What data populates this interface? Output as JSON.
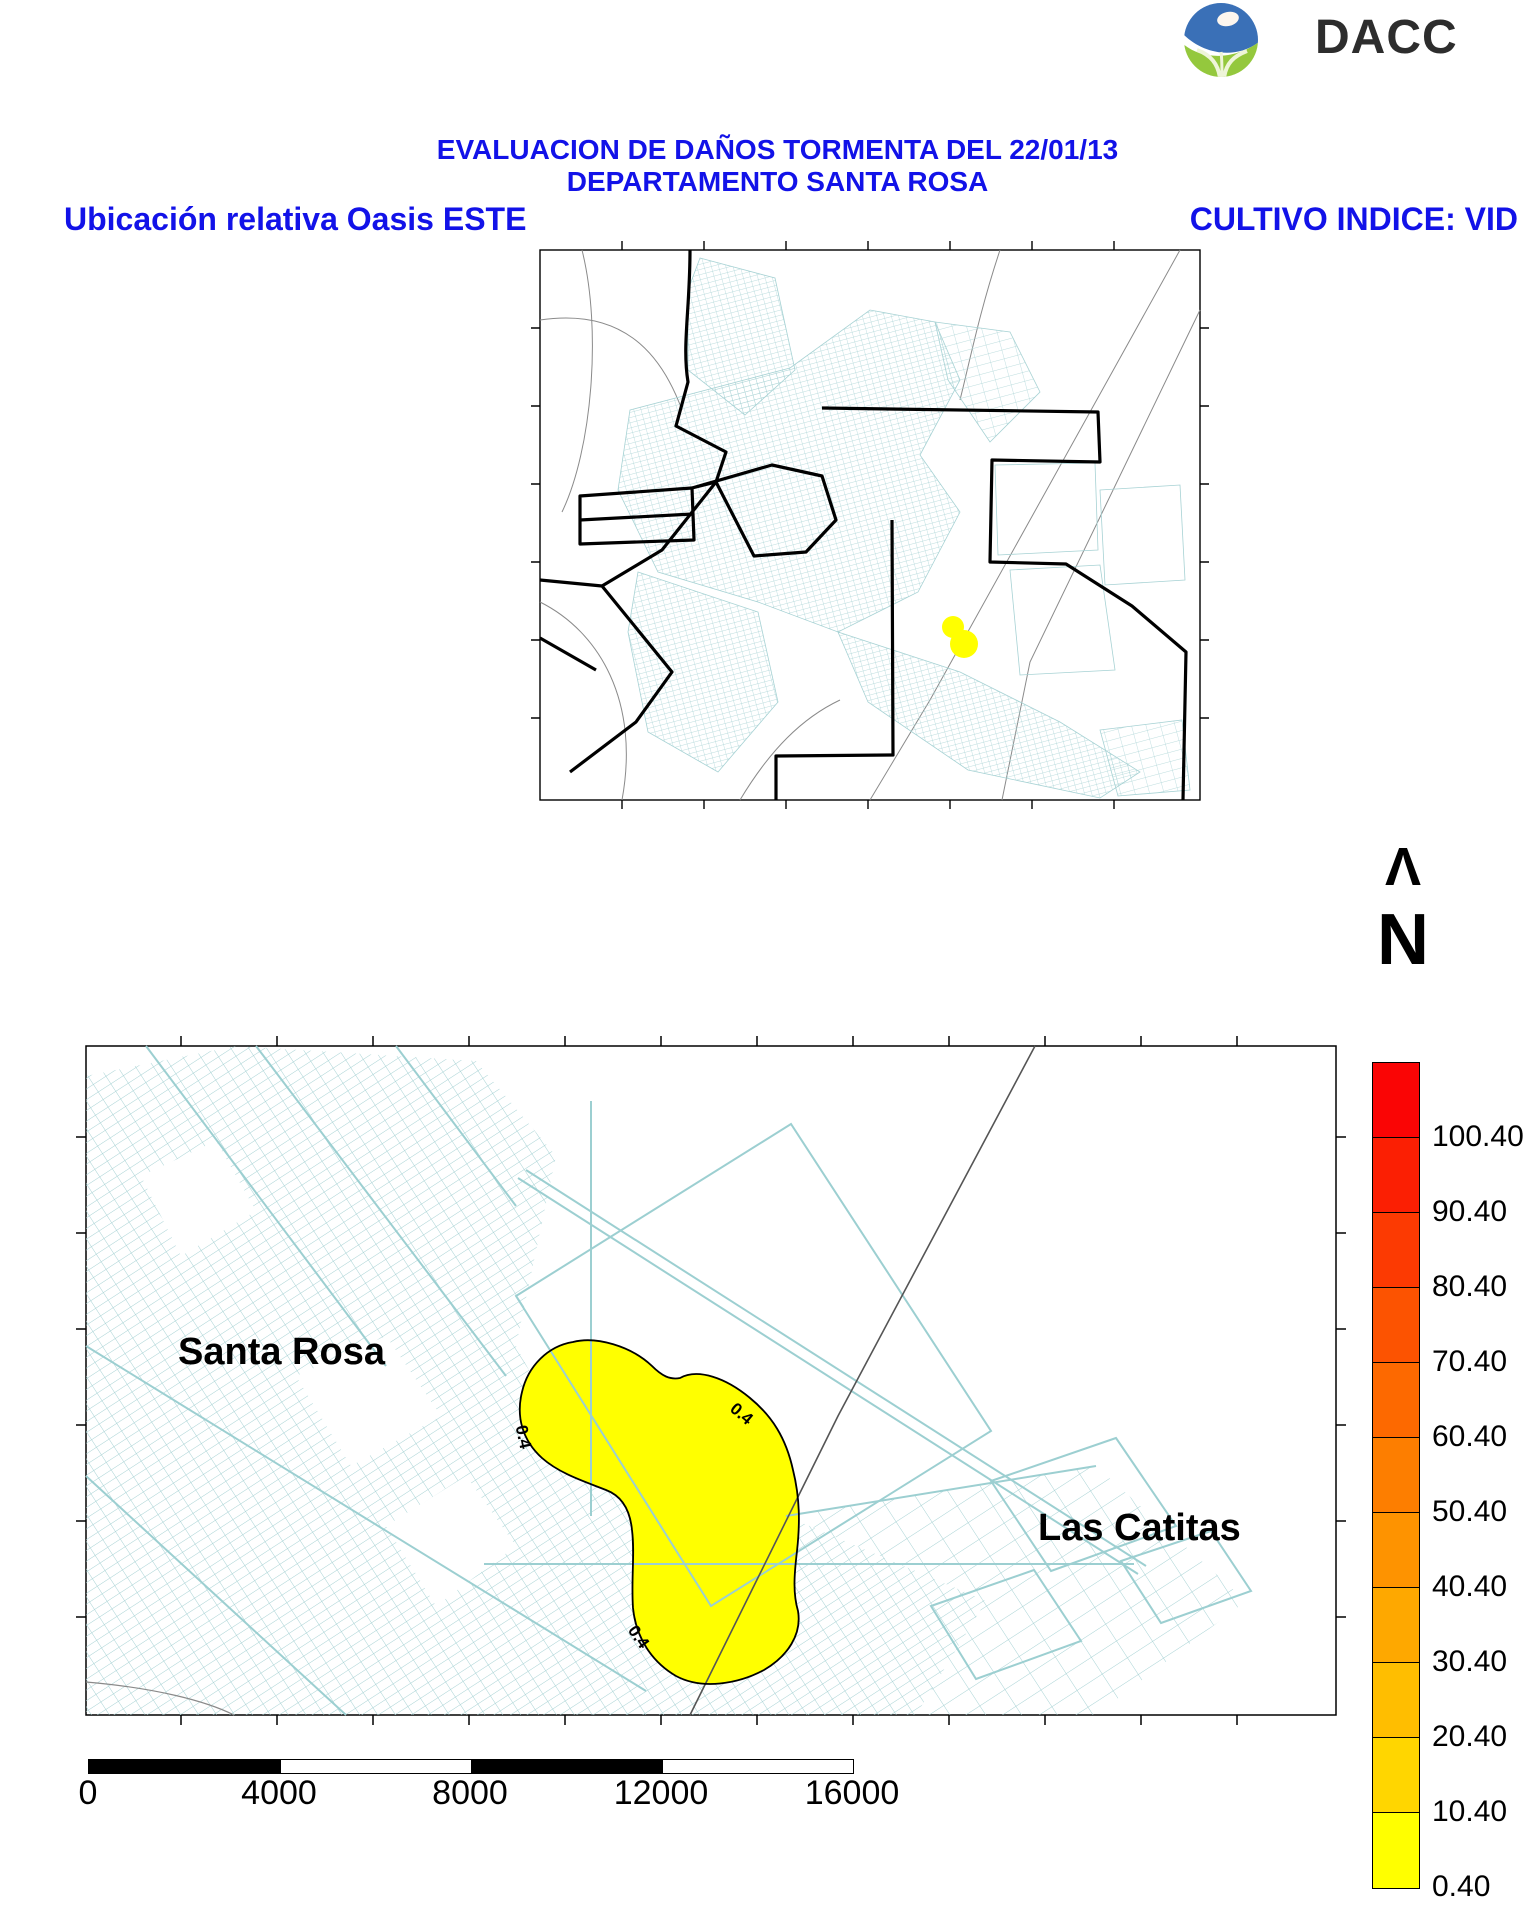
{
  "logo": {
    "text": "DACC"
  },
  "header": {
    "title_line1": "EVALUACION DE DAÑOS TORMENTA DEL 22/01/13",
    "title_line2": "DEPARTAMENTO SANTA ROSA",
    "left_label": "Ubicación relativa Oasis ESTE",
    "right_label": "CULTIVO INDICE: VID"
  },
  "north": {
    "arrow_glyph": "Λ",
    "label": "N"
  },
  "main_map": {
    "region_labels": {
      "left": "Santa Rosa",
      "right": "Las Catitas"
    },
    "contour_labels": [
      "0.4",
      "0.4",
      "0.4"
    ]
  },
  "colorbar": {
    "labels": [
      "100.40",
      "90.40",
      "80.40",
      "70.40",
      "60.40",
      "50.40",
      "40.40",
      "30.40",
      "20.40",
      "10.40",
      "0.40"
    ],
    "colors_top_to_bottom": [
      "#fa0505",
      "#fb1f03",
      "#fc3a02",
      "#fc5301",
      "#fd6900",
      "#fd7e00",
      "#fe9300",
      "#fea800",
      "#ffbe00",
      "#ffd600",
      "#ffff00"
    ]
  },
  "scalebar": {
    "ticks": [
      "0",
      "4000",
      "8000",
      "12000",
      "16000"
    ]
  },
  "palette": {
    "title_blue": "#1212e8",
    "parcel_teal": "#a7d2d4",
    "highlight_yellow": "#ffff00",
    "boundary_black": "#000000",
    "road_gray": "#8a8a8a"
  }
}
